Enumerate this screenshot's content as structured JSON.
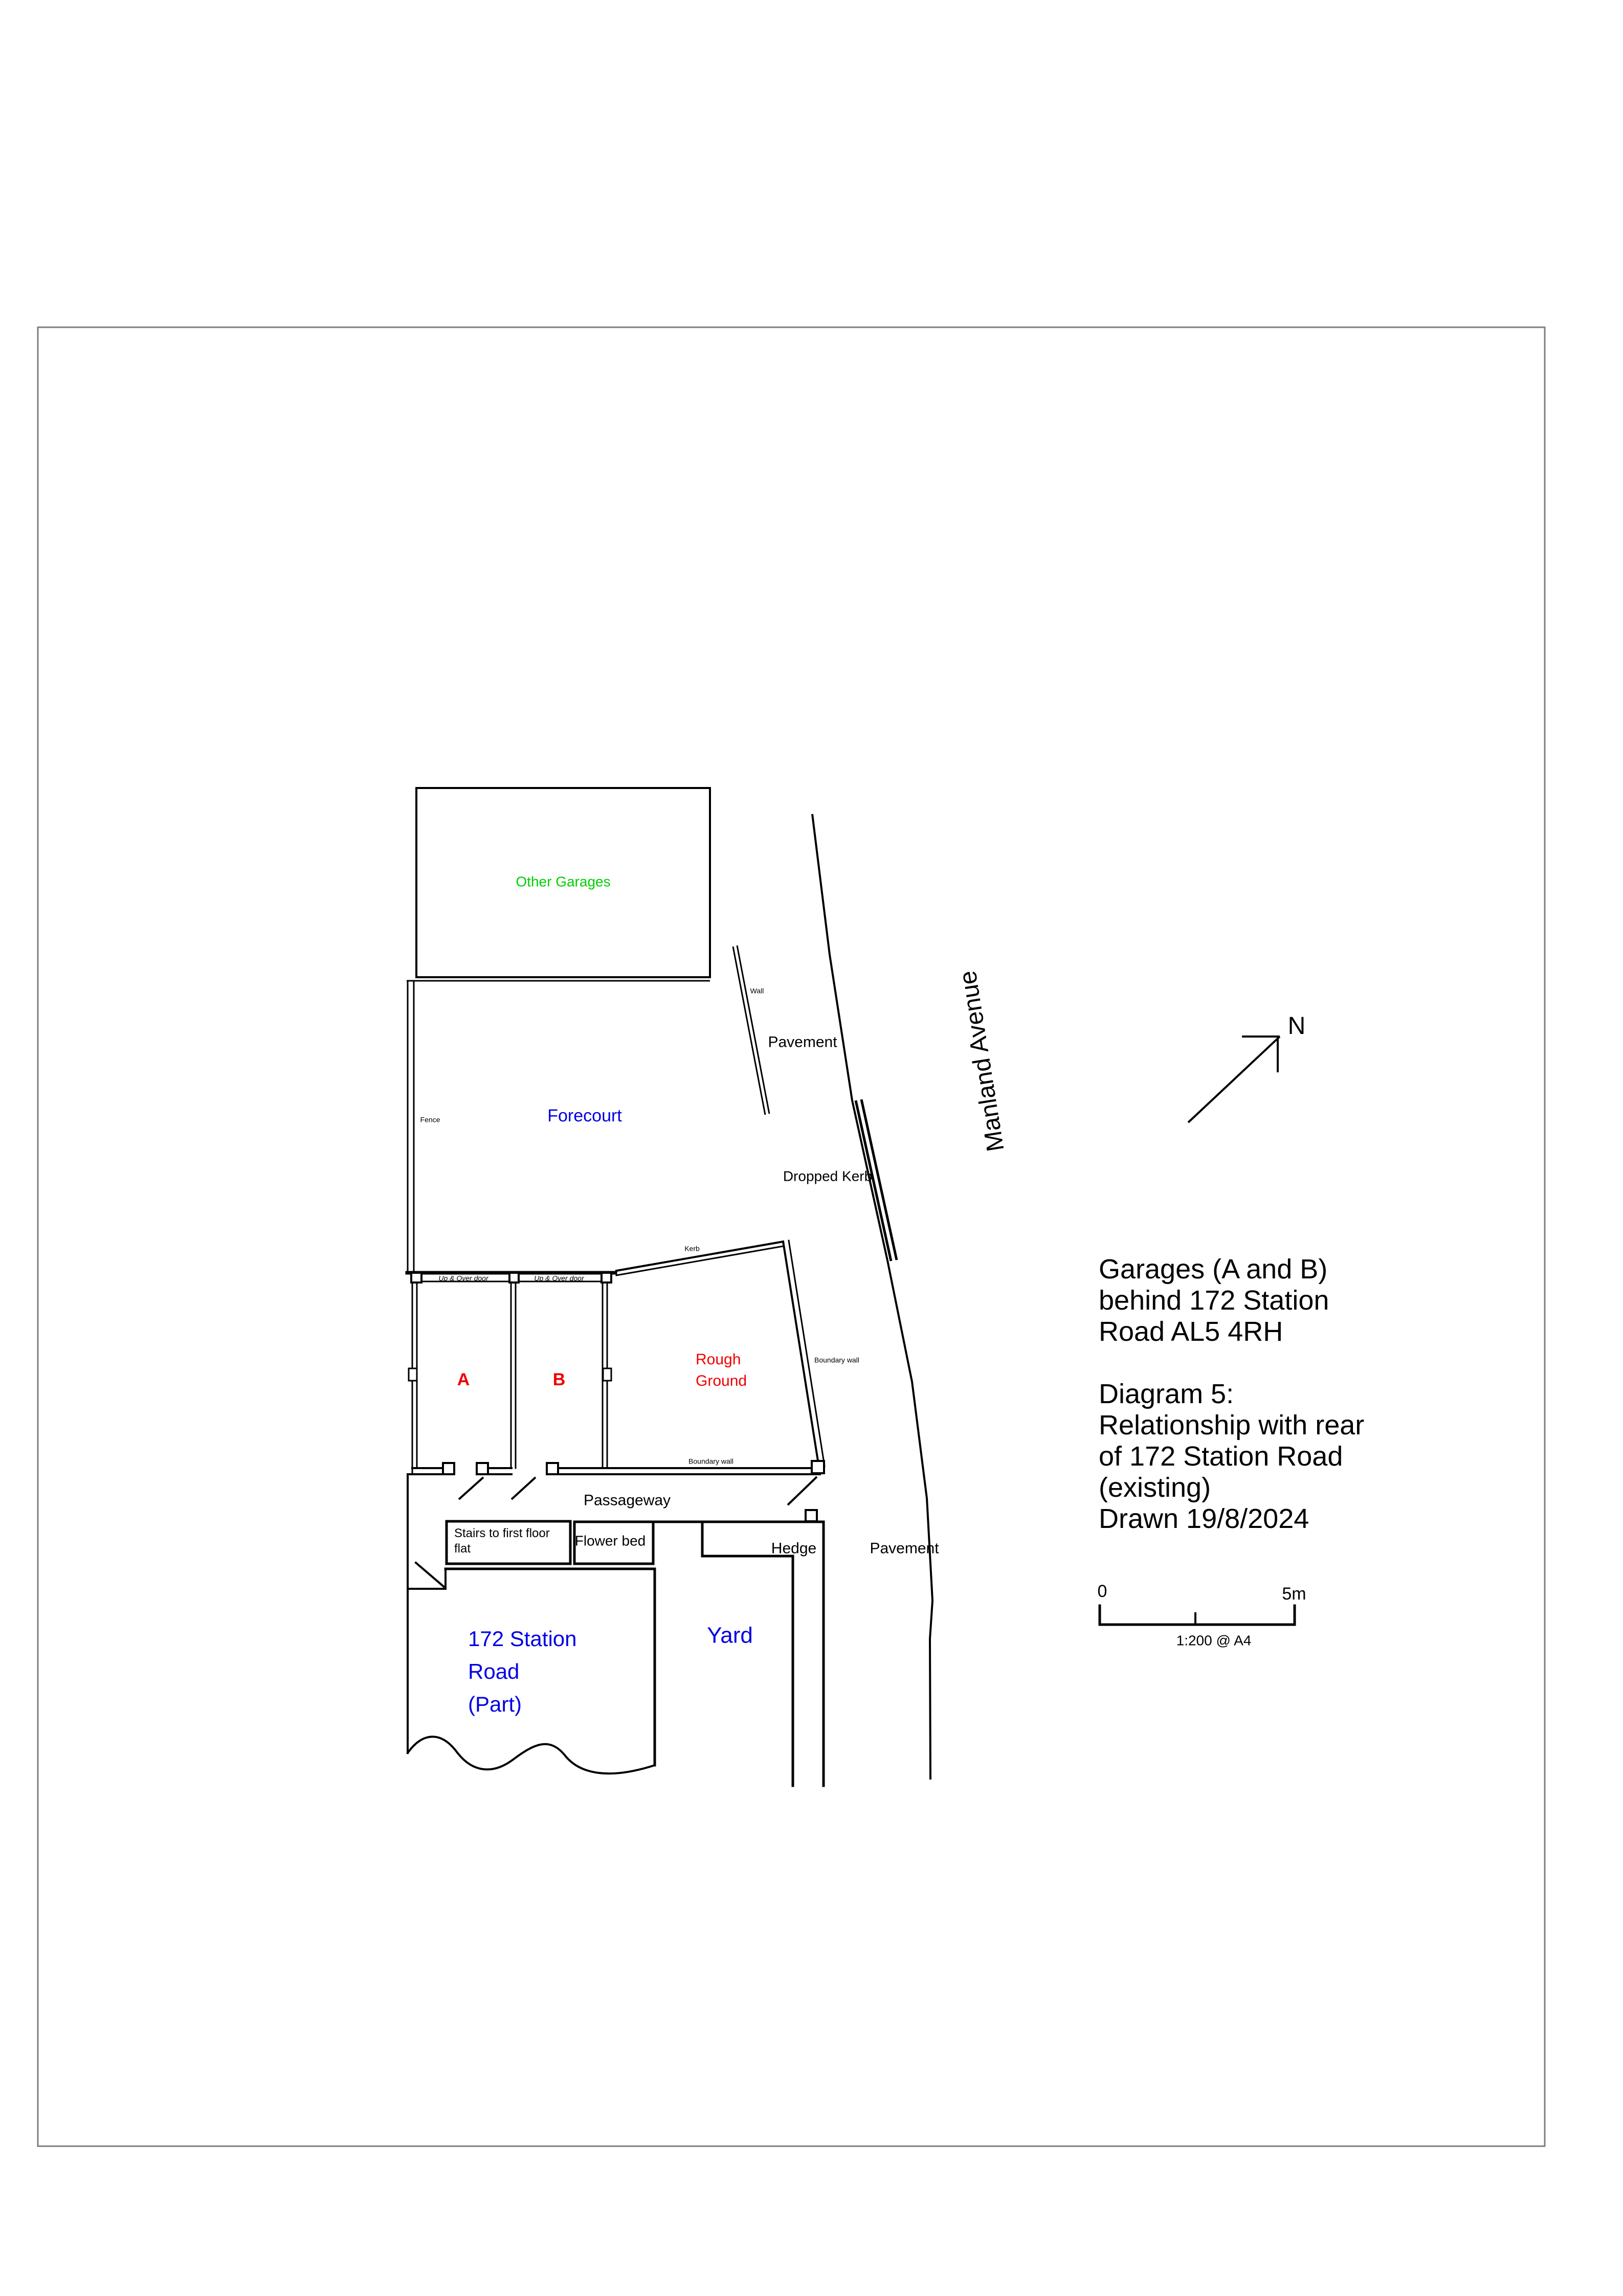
{
  "colors": {
    "line": "#000000",
    "page_border": "#7E7E7E",
    "label_green": "#00CF00",
    "label_blue": "#0000E6",
    "label_red": "#F00000"
  },
  "plan": {
    "other_garages": "Other Garages",
    "forecourt": "Forecourt",
    "fence": "Fence",
    "wall": "Wall",
    "pavement_upper": "Pavement",
    "dropped_kerb": "Dropped Kerb",
    "street": "Manland Avenue",
    "kerb": "Kerb",
    "garage_a": "A",
    "garage_b": "B",
    "up_over_door_a": "Up & Over door",
    "up_over_door_b": "Up & Over door",
    "rough_ground": "Rough\nGround",
    "boundary_wall_right": "Boundary wall",
    "boundary_wall_bottom": "Boundary wall",
    "passageway": "Passageway",
    "stairs": "Stairs to first floor\nflat",
    "flower_bed": "Flower bed",
    "hedge": "Hedge",
    "pavement_lower": "Pavement",
    "yard": "Yard",
    "house": "172 Station\nRoad\n(Part)"
  },
  "compass": {
    "north": "N"
  },
  "title_block": {
    "text": "Garages (A and B)\nbehind 172 Station\nRoad AL5 4RH\n\nDiagram 5:\nRelationship with rear\nof 172 Station Road\n(existing)\nDrawn 19/8/2024"
  },
  "scale_bar": {
    "zero": "0",
    "max": "5m",
    "ratio": "1:200 @ A4"
  }
}
